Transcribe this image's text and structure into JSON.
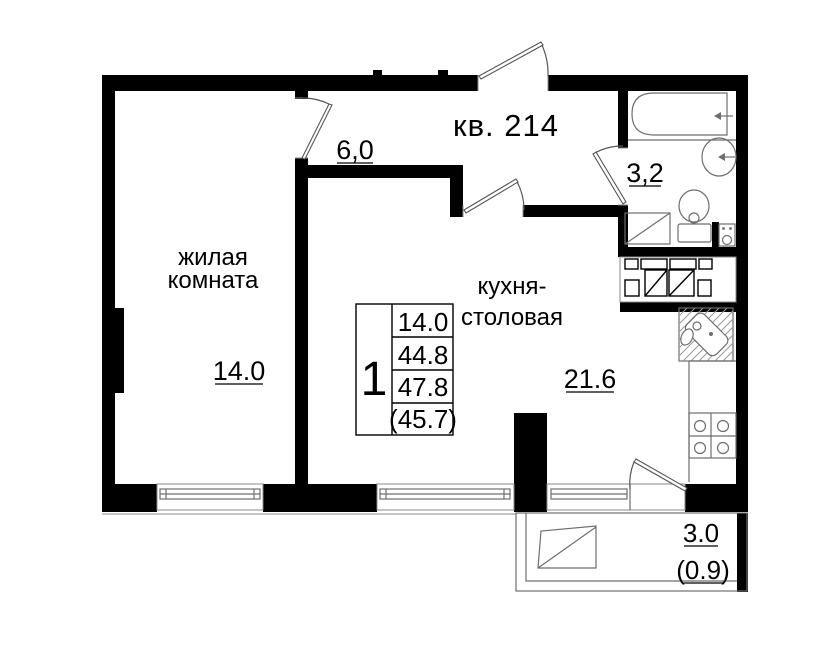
{
  "plan": {
    "apartment_label": "кв. 214",
    "colors": {
      "wall": "#000000",
      "thin_line": "#6e6e6e",
      "background": "#ffffff",
      "text": "#000000"
    },
    "rooms": {
      "living": {
        "label_line1": "жилая",
        "label_line2": "комната",
        "area": "14.0"
      },
      "kitchen": {
        "label_line1": "кухня-",
        "label_line2": "столовая",
        "area": "21.6"
      },
      "hallway": {
        "area": "6,0"
      },
      "bathroom": {
        "area": "3,2"
      },
      "balcony": {
        "area": "3.0",
        "area_weighted": "(0.9)"
      }
    },
    "area_table": {
      "rooms_count": "1",
      "rows": [
        "14.0",
        "44.8",
        "47.8",
        "(45.7)"
      ]
    }
  }
}
